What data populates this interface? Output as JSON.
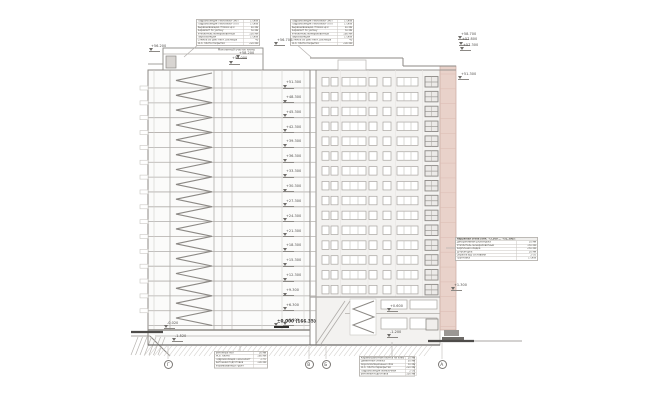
{
  "drawing": {
    "kind": "building section and elevation, 17-storey residential tower",
    "colors": {
      "line_strong": "#8c8985",
      "line_light": "#c9c6c2",
      "slab_line": "#b0ada9",
      "facade_fill": "#f3f2f0",
      "accent_pink": "#e9d2ca",
      "ground_dark": "#4e4c4a",
      "text": "#4f4d4a"
    }
  },
  "tables": {
    "roof_left": {
      "rows": [
        {
          "l": "Гидроизоляция Техноэласт ЭКП",
          "v": "1 слой"
        },
        {
          "l": "Гидроизоляция Техноэласт ХПП",
          "v": "1 слой"
        },
        {
          "l": "Выравнивающая стяжка ЦПР",
          "v": "40 мм"
        },
        {
          "l": "Керамзит по уклону",
          "v": "50 мм"
        },
        {
          "l": "Утеплитель минераловатный",
          "v": "150 мм"
        },
        {
          "l": "Пароизоляция",
          "v": "1 слой"
        },
        {
          "l": "Стяжка из цем.-песч. раствора",
          "v": "40"
        },
        {
          "l": "Ж.б. плита покрытия",
          "v": "220 мм"
        }
      ]
    },
    "roof_right": {
      "rows": [
        {
          "l": "Гидроизоляция Техноэласт ЭКП",
          "v": "1 слой"
        },
        {
          "l": "Гидроизоляция Техноэласт ХПП",
          "v": "1 слой"
        },
        {
          "l": "Выравнивающая стяжка ЦПР",
          "v": "40 мм"
        },
        {
          "l": "Керамзит по уклону",
          "v": "50 мм"
        },
        {
          "l": "Утеплитель минераловатный",
          "v": "180 мм"
        },
        {
          "l": "Пароизоляция",
          "v": "1 слой"
        },
        {
          "l": "Стяжка из цем.-песч. раствора",
          "v": "40"
        },
        {
          "l": "Ж.б. плита покрытия",
          "v": "200 мм"
        }
      ]
    },
    "wall_right": {
      "rows": [
        {
          "l": "Наружная стена (отм. +3.300 ... +51.300):",
          "v": ""
        },
        {
          "l": "Декоративная штукатурка",
          "v": "10 мм"
        },
        {
          "l": "Утеплитель минераловатный",
          "v": "150 мм"
        },
        {
          "l": "Кирпичная кладка",
          "v": "250 мм"
        },
        {
          "l": "Штукатурка",
          "v": "20 мм"
        },
        {
          "l": "Окраска в/д составами",
          "v": "2 сл."
        },
        {
          "l": "Грунтовка",
          "v": "1 слой"
        }
      ]
    },
    "floor_bottom_left": {
      "rows": [
        {
          "l": "Бетонный пол",
          "v": "30 мм"
        },
        {
          "l": "Ж.б. плита",
          "v": "160 мм"
        },
        {
          "l": "Гидроизоляция Техноэласт",
          "v": "2 сл."
        },
        {
          "l": "Бетонная подготовка",
          "v": "100 мм"
        },
        {
          "l": "Утрамбованный грунт",
          "v": ""
        }
      ]
    },
    "floor_bottom_right": {
      "rows": [
        {
          "l": "Керамогранитная плитка на клею",
          "v": "20 мм"
        },
        {
          "l": "Цементная стяжка",
          "v": "50 мм"
        },
        {
          "l": "Звукоизоляционный слой",
          "v": "30 мм"
        },
        {
          "l": "Ж.б. плита перекрытия",
          "v": "220 мм"
        },
        {
          "l": "Гидроизоляция обмазочная",
          "v": "2 сл."
        },
        {
          "l": "Бетонная подготовка",
          "v": "100 мм"
        }
      ]
    }
  },
  "levels": {
    "section": [
      "+51.300",
      "+48.300",
      "+45.300",
      "+42.300",
      "+39.300",
      "+36.300",
      "+33.300",
      "+30.300",
      "+27.300",
      "+24.300",
      "+21.300",
      "+18.300",
      "+15.300",
      "+12.300",
      "+9.300",
      "+6.300",
      "+3.300"
    ],
    "roof": [
      "+56.200",
      "+56.700",
      "+58.200",
      "+58.000"
    ],
    "roof_note": "Монолитный участок плиты",
    "right_top": [
      "+58.700",
      "+57.800",
      "+57.300",
      "+51.300"
    ],
    "ground": [
      "-0.020",
      "-1.520"
    ],
    "zero": "±0.000 (166.35)",
    "right_low": [
      "+0.600",
      "-1.200",
      "+1.300"
    ]
  },
  "axes": {
    "bubbles": [
      "Г",
      "В",
      "Б",
      "А"
    ]
  }
}
